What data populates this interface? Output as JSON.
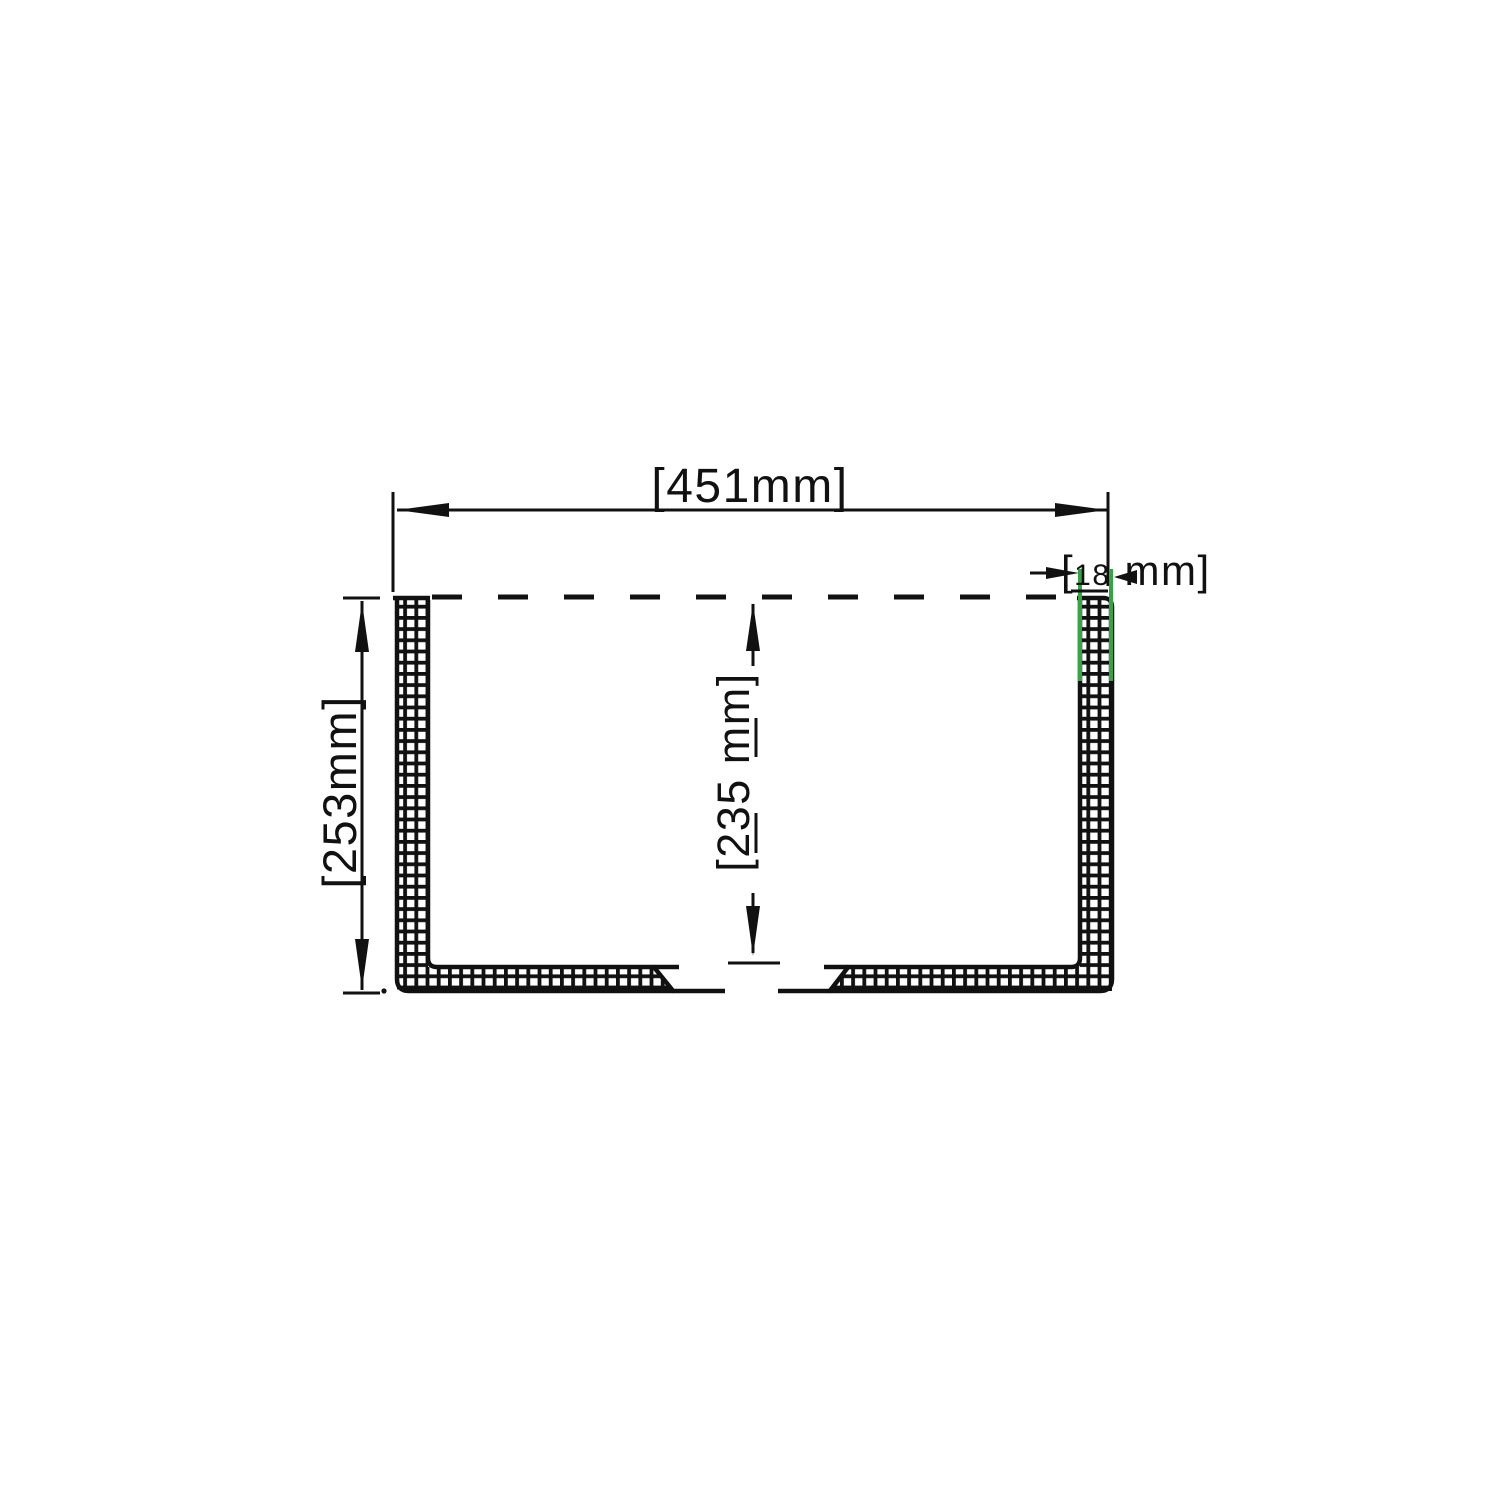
{
  "labels": {
    "overall_width": "[451mm]",
    "overall_height": "[253mm]",
    "inner_height": "[235 mm]",
    "thickness_open_bracket": "[",
    "thickness_value": "18",
    "thickness_unit": "mm]"
  },
  "colors": {
    "ink": "#111111",
    "thickness_highlight": "#35a544",
    "background": "#ffffff"
  }
}
